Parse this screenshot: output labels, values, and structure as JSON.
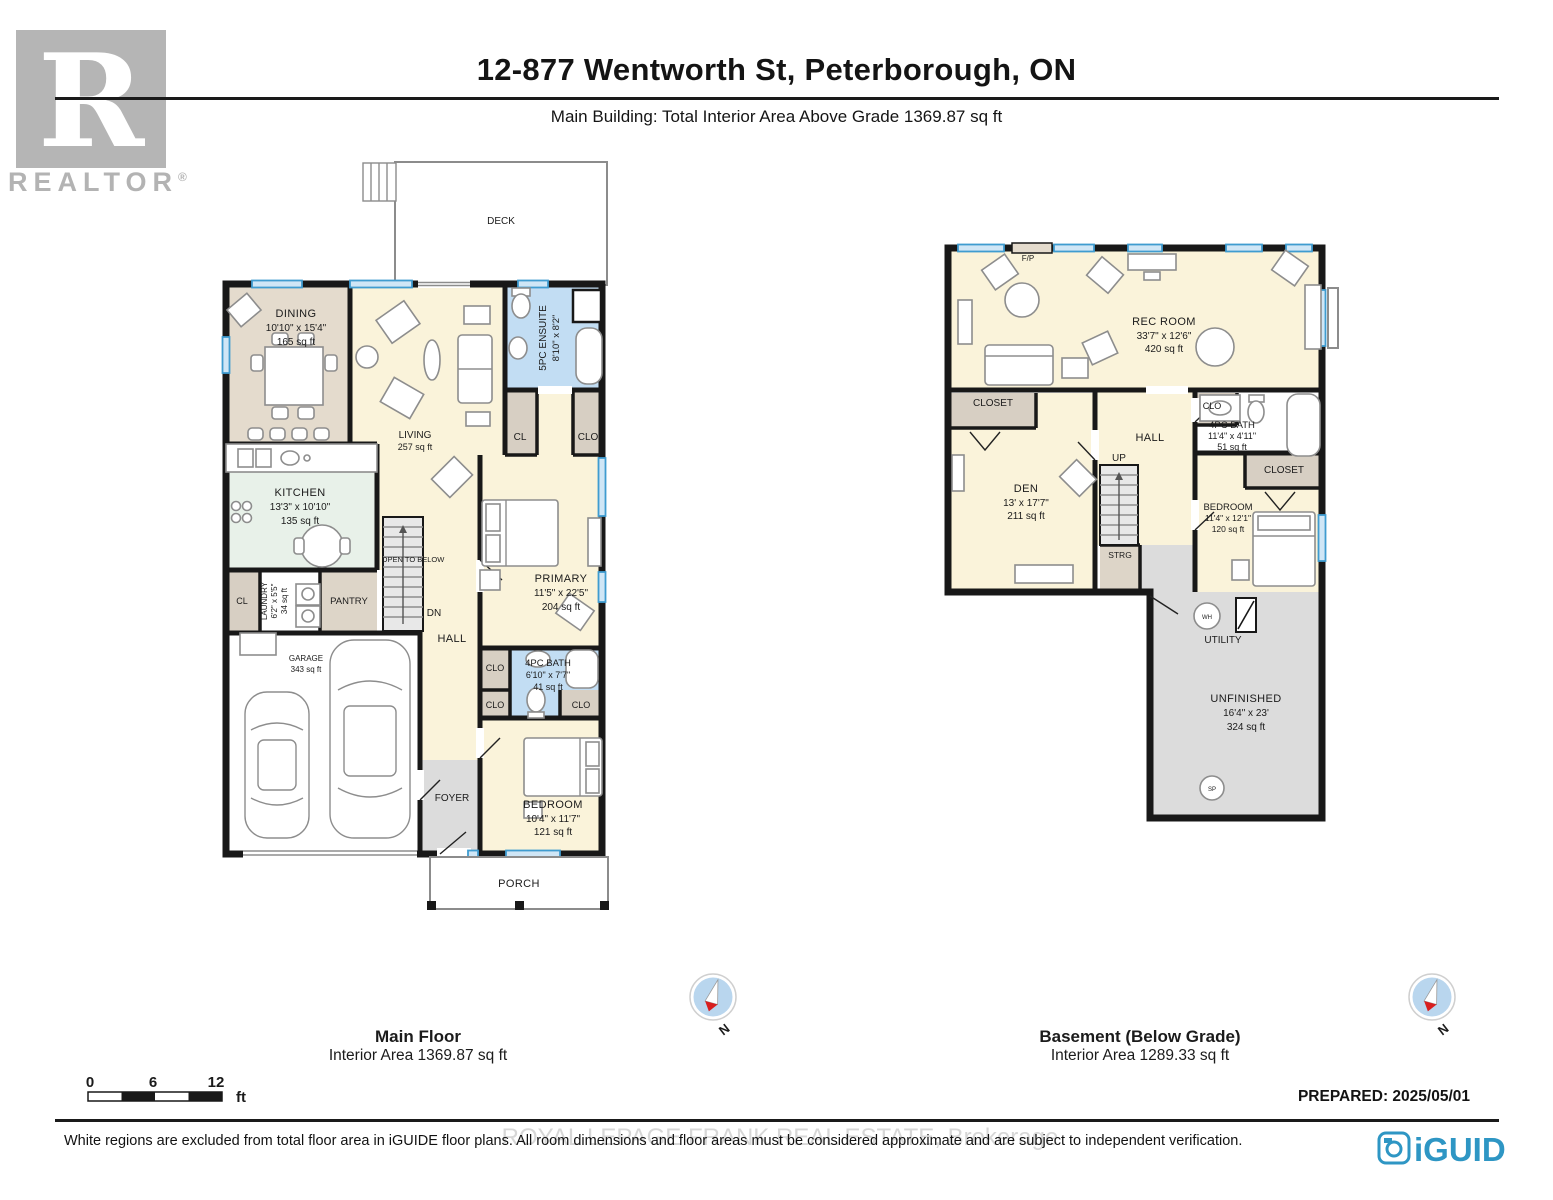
{
  "header": {
    "title": "12-877 Wentworth St, Peterborough, ON",
    "subtitle": "Main Building: Total Interior Area Above Grade 1369.87 sq ft"
  },
  "branding": {
    "realtor_r": "R",
    "realtor": "REALTOR",
    "registered": "®",
    "iguide": "iGUIDE",
    "prepared": "PREPARED: 2025/05/01"
  },
  "footer": {
    "watermark": "ROYAL LEPAGE FRANK REAL ESTATE, Brokerage",
    "disclaimer": "White regions are excluded from total floor area in iGUIDE floor plans. All room dimensions and floor areas must be considered approximate and are subject to independent verification."
  },
  "scale_bar": {
    "t0": "0",
    "t6": "6",
    "t12": "12",
    "unit": "ft"
  },
  "compass": {
    "north": "N"
  },
  "misc": {
    "cl": "CL",
    "clo": "CLO",
    "closet": "CLOSET"
  },
  "main_floor": {
    "title": "Main Floor",
    "area_label": "Interior Area 1369.87 sq ft",
    "rooms": {
      "deck": "DECK",
      "dining": {
        "name": "DINING",
        "dims": "10'10\" x 15'4\"",
        "area": "165 sq ft"
      },
      "living": {
        "name": "LIVING",
        "area": "257 sq ft"
      },
      "kitchen": {
        "name": "KITCHEN",
        "dims": "13'3\" x 10'10\"",
        "area": "135 sq ft"
      },
      "ensuite": {
        "name": "5PC ENSUITE",
        "dims": "8'10\" x 8'2\""
      },
      "primary": {
        "name": "PRIMARY",
        "dims": "11'5\" x 22'5\"",
        "area": "204 sq ft"
      },
      "laundry": {
        "name": "LAUNDRY",
        "dims": "6'2\" x 5'5\"",
        "area": "34 sq ft"
      },
      "pantry": "PANTRY",
      "garage": {
        "name": "GARAGE",
        "area": "343 sq ft"
      },
      "hall": "HALL",
      "bath": {
        "name": "4PC BATH",
        "dims": "6'10\" x 7'7\"",
        "area": "41 sq ft"
      },
      "bedroom": {
        "name": "BEDROOM",
        "dims": "10'4\" x 11'7\"",
        "area": "121 sq ft"
      },
      "foyer": "FOYER",
      "porch": "PORCH"
    },
    "labels": {
      "open_to_below": "OPEN TO BELOW",
      "dn": "DN"
    }
  },
  "basement": {
    "title": "Basement (Below Grade)",
    "area_label": "Interior Area 1289.33 sq ft",
    "rooms": {
      "fp": "F/P",
      "rec_room": {
        "name": "REC ROOM",
        "dims": "33'7\" x 12'6\"",
        "area": "420 sq ft"
      },
      "den": {
        "name": "DEN",
        "dims": "13' x 17'7\"",
        "area": "211 sq ft"
      },
      "hall": "HALL",
      "bath": {
        "name": "4PC BATH",
        "dims": "11'4\" x 4'11\"",
        "area": "51 sq ft"
      },
      "bedroom": {
        "name": "BEDROOM",
        "dims": "11'4\" x 12'1\"",
        "area": "120 sq ft"
      },
      "strg": "STRG",
      "utility": "UTILITY",
      "unfinished": {
        "name": "UNFINISHED",
        "dims": "16'4\" x 23'",
        "area": "324 sq ft"
      }
    },
    "labels": {
      "up": "UP",
      "wh": "WH",
      "sp": "SP"
    }
  },
  "colors": {
    "wall": "#181818",
    "window_blue": "#3f9cd0",
    "bath_blue": "#c2ddf3",
    "floor_yellow": "#faf3da",
    "dining_tan": "#e4dbcd",
    "kitchen_mint": "#e8f1e9",
    "closet_tan": "#d7cfc3",
    "utility_gray": "#dcdcdc",
    "iguide_blue": "#2e96c4",
    "realtor_gray": "#b5b5b5",
    "compass_red": "#d81f1f"
  }
}
